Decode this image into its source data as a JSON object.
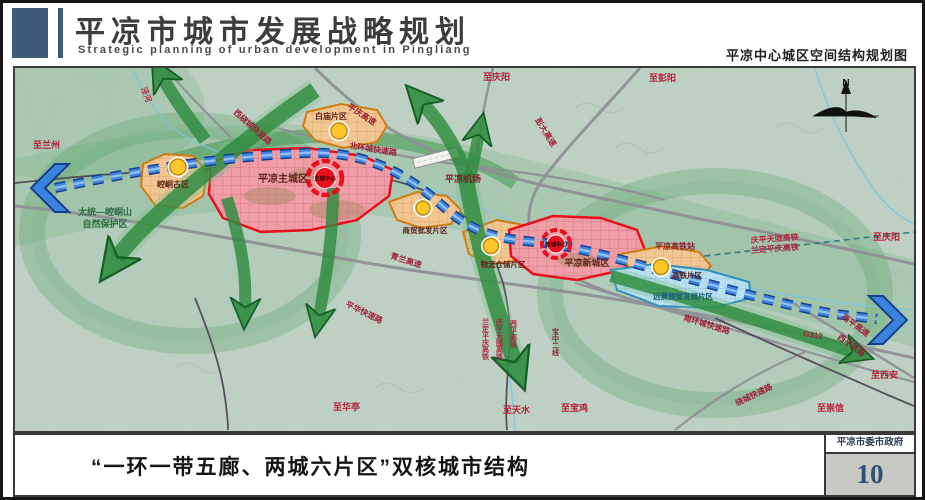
{
  "header": {
    "title": "平凉市城市发展战略规划",
    "subtitle": "Strategic planning of urban development in Pingliang",
    "map_label": "平凉中心城区空间结构规划图"
  },
  "footer": {
    "caption": "“一环一带五廊、两城六片区”双核城市结构",
    "stamp_org": "平凉市委市政府",
    "page_number": "10"
  },
  "map": {
    "compass": "N",
    "districts": {
      "kongtong": "崆峒古区",
      "main_city": "平凉主城区",
      "baimiao": "白庙片区",
      "trade": "商贸批发片区",
      "logistics": "物流仓储片区",
      "new_city": "平凉新城区",
      "hsr": "高铁片区",
      "reserve_dev": "远景预留发展片区"
    },
    "centers": {
      "main": "主城中心",
      "new": "新城中心"
    },
    "stations": {
      "airport": "平凉机场",
      "hsr_station": "平凉高铁站"
    },
    "roads": {
      "west_ring": "西绕城快速路",
      "pingqing": "平庆高速",
      "pengda": "彭大高速",
      "north_ring": "北环城快速路",
      "qinglan": "青兰高速",
      "pinghua": "平华快速路",
      "south_ring": "南环城快速路",
      "g312": "G312",
      "xiping_expwy": "西平高速",
      "xiping_rail": "西平铁路",
      "ring_expwy": "绕城快速路"
    },
    "railways": {
      "qptl": "庆平天陇高铁",
      "ldpq": "兰定平庆高铁",
      "xiping_hsr": "西平高铁",
      "baozhong2": "宝中二线"
    },
    "destinations": {
      "lanzhou": "至兰州",
      "qingyang_n": "至庆阳",
      "pengyang": "至彭阳",
      "qingyang_e": "至庆阳",
      "xian": "至西安",
      "chongxin": "至崇信",
      "baoji": "至宝鸡",
      "tianshui": "至天水",
      "huating": "至华亭"
    },
    "nature_reserve": {
      "line1": "太统—崆峒山",
      "line2": "自然保护区"
    },
    "river": "泾河",
    "colors": {
      "corridor_green": "#2e8b3e",
      "belt_blue": "#3f83de",
      "city_red": "#e8101e",
      "district_orange": "#cf7d12",
      "reserve_blue": "#2e8fc0",
      "accent_slate": "#3c5b77"
    }
  }
}
